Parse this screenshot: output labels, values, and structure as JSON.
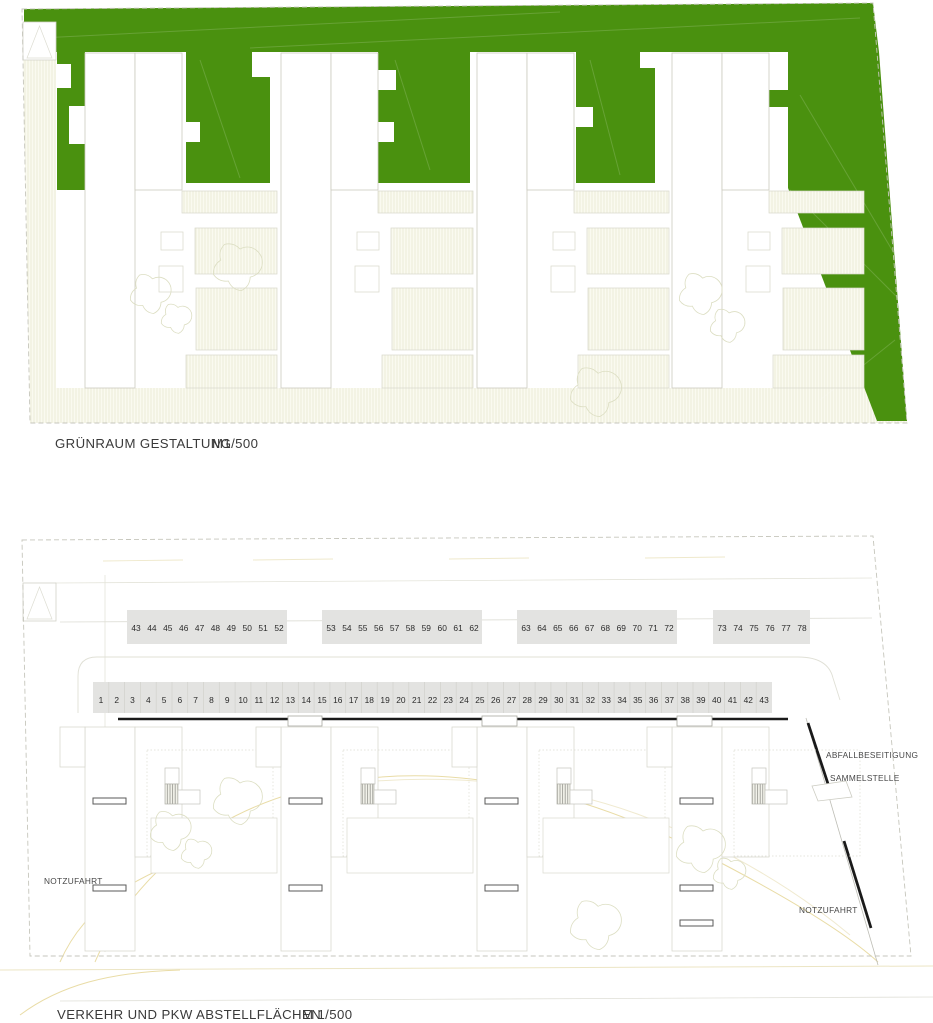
{
  "top_plan": {
    "name": "GRÜNRAUM GESTALTUNG",
    "scale": "M1/500"
  },
  "bottom_plan": {
    "name": "VERKEHR UND PKW ABSTELLFLÄCHEN",
    "scale": "M 1/500",
    "labels": {
      "notzufahrt_left": "NOTZUFAHRT",
      "abfallbeseitigung": "ABFALLBESEITIGUNG",
      "sammelstelle": "SAMMELSTELLE",
      "notzufahrt_right": "NOTZUFAHRT"
    },
    "parking": {
      "front_row": [
        1,
        2,
        3,
        4,
        5,
        6,
        7,
        8,
        9,
        10,
        11,
        12,
        13,
        14,
        15,
        16,
        17,
        18,
        19,
        20,
        21,
        22,
        23,
        24,
        25,
        26,
        27,
        28,
        29,
        30,
        31,
        32,
        33,
        34,
        35,
        36,
        37,
        38,
        39,
        40,
        41,
        42,
        43
      ],
      "back_blocks": [
        [
          43,
          44,
          45,
          46,
          47,
          48,
          49,
          50,
          51,
          52
        ],
        [
          53,
          54,
          55,
          56,
          57,
          58,
          59,
          60,
          61,
          62
        ],
        [
          63,
          64,
          65,
          66,
          67,
          68,
          69,
          70,
          71,
          72
        ],
        [
          73,
          74,
          75,
          76,
          77,
          78
        ]
      ]
    }
  },
  "colors": {
    "grass_green": "#4a910f",
    "parking_fill": "#e3e3e1",
    "number_text": "#2b2b2b",
    "boundary_gray": "#c6c6bc",
    "black_line": "#1a1a1a",
    "path_tan": "#e9dca6",
    "hatch_cream": "#e9e9d4"
  }
}
